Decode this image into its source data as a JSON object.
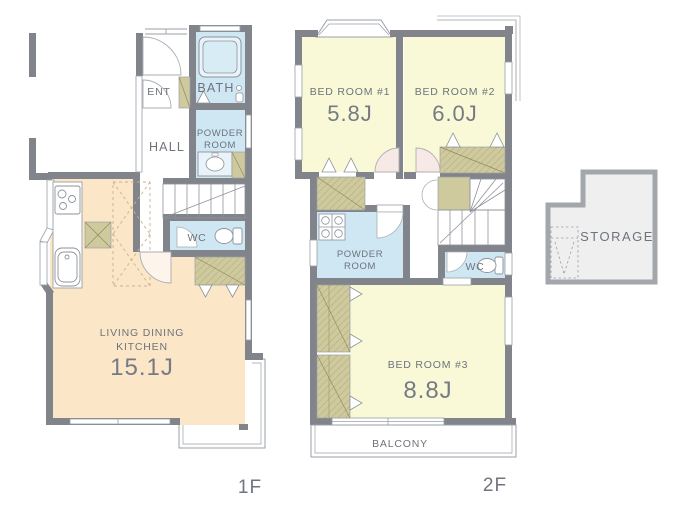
{
  "palette": {
    "wall": "#81848a",
    "thin_line": "#9aa0a6",
    "ldk_fill": "#fbe6c8",
    "bedroom_fill": "#f9f9d8",
    "water_fill": "#cfe7f3",
    "closet_fill": "#cfca9e",
    "storage_fill": "#efefef",
    "door_fill": "#f7eae6",
    "text": "#6e737b"
  },
  "floor1": {
    "floor_label": "1F",
    "ent": "ENT",
    "bath": "BATH",
    "hall": "HALL",
    "powder_line1": "POWDER",
    "powder_line2": "ROOM",
    "wc": "WC",
    "ldk_line1": "LIVING DINING",
    "ldk_line2": "KITCHEN",
    "ldk_area": "15.1J"
  },
  "floor2": {
    "floor_label": "2F",
    "bed1_name": "BED ROOM #1",
    "bed1_area": "5.8J",
    "bed2_name": "BED ROOM #2",
    "bed2_area": "6.0J",
    "bed3_name": "BED ROOM #3",
    "bed3_area": "8.8J",
    "powder_line1": "POWDER",
    "powder_line2": "ROOM",
    "wc": "WC",
    "balcony": "BALCONY"
  },
  "storage": {
    "label": "STORAGE"
  }
}
